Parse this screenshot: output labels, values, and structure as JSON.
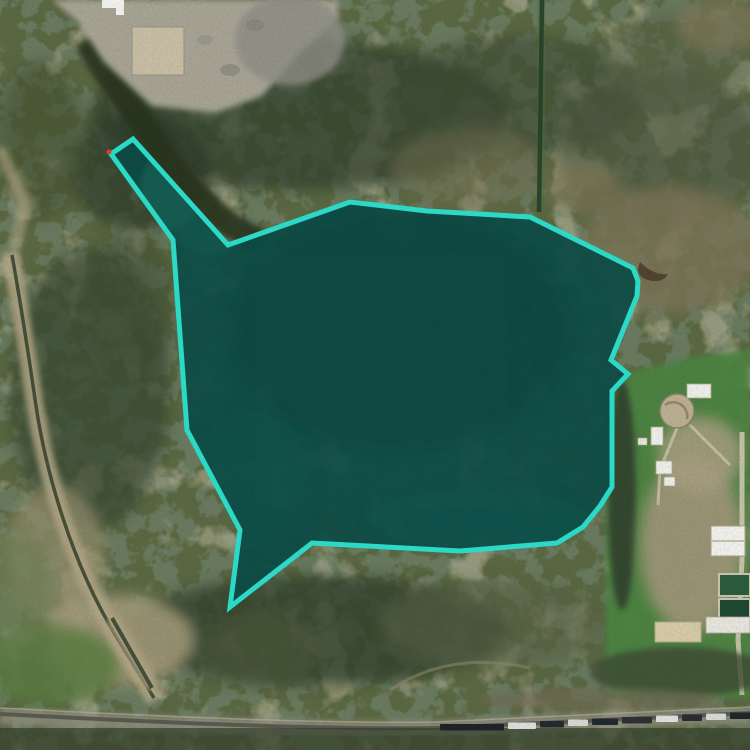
{
  "map_view": {
    "canvas": {
      "width": 750,
      "height": 750
    },
    "highlight_polygon": {
      "points": "133,139 228,245 350,202 427,211 530,217 633,268 638,281 637,296 611,360 628,374 612,391 612,487 600,506 583,527 557,543 460,551 312,543 230,607 240,530 187,430 173,240 111,154",
      "stroke_color": "#2bd9c6",
      "stroke_width": 5,
      "fill_color": "#0b4b46",
      "fill_opacity": 0.92
    },
    "marker_dot": {
      "cx": 109,
      "cy": 152,
      "r": 2.5,
      "fill_color": "#d9402b"
    }
  }
}
